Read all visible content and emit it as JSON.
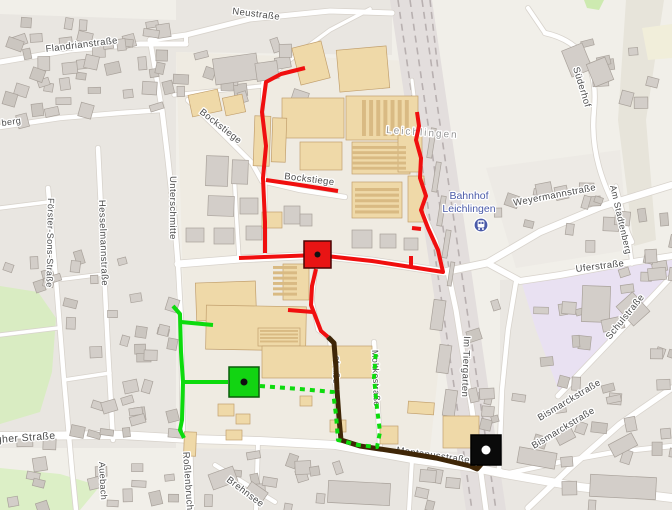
{
  "map": {
    "colors": {
      "base": "#f1efe9",
      "residential": "#e9e6e1",
      "industrial_land": "#efebe2",
      "park": "#d9ecc2",
      "school_area": "#e9e1f2",
      "railway_band": "#e3dedd",
      "railway_track": "#b8b0b0",
      "road_fill": "#ffffff",
      "road_casing": "#d8d3cc",
      "building_grey": "#d3cec9",
      "building_grey_stroke": "#a9a29b",
      "building_beige": "#efd9a8",
      "building_beige_stroke": "#c2a06e",
      "building_rows": "#d9ba83",
      "label_color": "#4c4c4c",
      "railway_label_color": "#969696",
      "station_color": "#4a5aa8",
      "route_red": "#f00f0f",
      "route_green": "#0ddb0d",
      "route_brown": "#3f2607"
    },
    "areas": [
      {
        "name": "residential-left",
        "d": "M0,14 L176,20 L176,448 L0,448 Z",
        "fill": "#e9e6e1",
        "opacity": 1
      },
      {
        "name": "residential-top",
        "d": "M176,0 L392,0 L392,55 L176,52 Z",
        "fill": "#e9e6e1",
        "opacity": 1
      },
      {
        "name": "residential-bottom",
        "d": "M188,448 L470,452 L470,510 L188,510 Z",
        "fill": "#e9e6e1",
        "opacity": 1
      },
      {
        "name": "residential-right",
        "d": "M500,280 L672,270 L672,510 L500,510 Z",
        "fill": "#eae7e2",
        "opacity": 1
      },
      {
        "name": "residential-rightmid",
        "d": "M486,168 L620,150 L628,250 L516,268 Z",
        "fill": "#ebe8e3",
        "opacity": 0.7
      },
      {
        "name": "industrial-center",
        "d": "M176,52 L440,62 L448,280 L430,450 L188,448 Z",
        "fill": "#efebe2",
        "opacity": 1
      },
      {
        "name": "park-left",
        "d": "M0,286 L38,292 L56,318 L52,372 L40,412 L0,424 Z",
        "fill": "#d9ecc2",
        "opacity": 1
      },
      {
        "name": "park-bottomleft",
        "d": "M0,468 L60,474 L100,486 L80,510 L0,510 Z",
        "fill": "#dcefc6",
        "opacity": 1
      },
      {
        "name": "green-topright",
        "d": "M584,0 L604,0 L599,10 L587,8 Z",
        "fill": "#cdeab0",
        "opacity": 1
      },
      {
        "name": "scrub-band-right",
        "d": "M626,0 L664,0 L646,120 L656,240 L634,246 L618,120 Z",
        "fill": "#dedacd",
        "opacity": 0.55
      },
      {
        "name": "farmland-right",
        "d": "M642,28 L672,24 L672,58 L648,60 Z",
        "fill": "#f1eeda",
        "opacity": 1
      },
      {
        "name": "school-area",
        "d": "M522,284 L672,258 L672,274 L560,394 L536,330 Z",
        "fill": "#e9e1f2",
        "opacity": 1
      }
    ],
    "railway": {
      "band": "M390,0 L432,0 L506,510 L466,510 Z",
      "tracks": [
        "M398,0 L472,510",
        "M410,0 L484,510",
        "M422,0 L496,510",
        "M430,0 L438,70"
      ]
    },
    "roads": [
      {
        "d": "M0,436 L120,435 L190,439 L260,441 L335,445 L412,459 L470,467 L505,474 L580,487 L672,498",
        "w": 8
      },
      {
        "d": "M178,264 L240,259 L317,255 L372,261 L412,267 L444,272 L487,263",
        "w": 7
      },
      {
        "d": "M487,263 L540,232 L600,207 L672,185",
        "w": 6.5
      },
      {
        "d": "M487,263 L520,281 L560,275 L620,264 L672,256",
        "w": 6
      },
      {
        "d": "M516,282 L508,330 L502,390 L499,470 L505,474",
        "w": 4.5
      },
      {
        "d": "M448,272 L456,310 L464,360 L472,410 L478,450 L480,466 L486,510",
        "w": 5
      },
      {
        "d": "M558,396 L600,352 L640,310 L672,276",
        "w": 5
      },
      {
        "d": "M528,508 L570,468 L620,424 L672,388",
        "w": 5.5
      },
      {
        "d": "M505,474 L560,462 L615,452 L672,446",
        "w": 4.5
      },
      {
        "d": "M545,33 C585,42 598,70 594,110 C590,150 602,185 622,220 L632,242",
        "w": 4.5
      },
      {
        "d": "M545,33 L528,8",
        "w": 4
      },
      {
        "d": "M616,186 L628,232 L632,264",
        "w": 3.5
      },
      {
        "d": "M0,62 L70,50 L140,44 L186,44",
        "w": 5
      },
      {
        "d": "M150,40 L186,35 L250,19 L330,11 L392,13",
        "w": 5
      },
      {
        "d": "M186,44 L186,35",
        "w": 4
      },
      {
        "d": "M0,127 L60,118 L120,113 L162,110",
        "w": 4.5
      },
      {
        "d": "M162,110 L168,160 L174,215 L178,264",
        "w": 5
      },
      {
        "d": "M150,40 L156,75 L162,110",
        "w": 4.5
      },
      {
        "d": "M174,95 L262,86",
        "w": 3.5
      },
      {
        "d": "M178,264 L181,320 L182,380 L183,440",
        "w": 4.5
      },
      {
        "d": "M190,440 L192,510",
        "w": 4.5
      },
      {
        "d": "M48,188 L56,280 L64,380 L72,470 L76,510",
        "w": 4.5
      },
      {
        "d": "M98,148 L103,250 L108,350 L113,440",
        "w": 4.5
      },
      {
        "d": "M0,208 L48,202",
        "w": 3.5
      },
      {
        "d": "M56,280 L104,274",
        "w": 3.5
      },
      {
        "d": "M64,380 L110,373",
        "w": 3.5
      },
      {
        "d": "M0,335 L58,328",
        "w": 3.5
      },
      {
        "d": "M370,9 L330,30 L296,55 L263,82 L262,140 L265,180 L265,252",
        "w": 3.5
      },
      {
        "d": "M188,100 L225,136 L252,163 L262,181",
        "w": 4.5
      },
      {
        "d": "M262,181 L300,190 L345,197",
        "w": 4.5
      },
      {
        "d": "M239,258 L236,210 L234,170",
        "w": 3.5
      },
      {
        "d": "M317,255 L312,300 L318,330 L330,339",
        "w": 3.5
      },
      {
        "d": "M330,339 L336,390 L340,443",
        "w": 4.5
      },
      {
        "d": "M374,342 L377,395 L380,445",
        "w": 4.5
      },
      {
        "d": "M258,442 L256,510",
        "w": 4
      },
      {
        "d": "M412,459 L409,510",
        "w": 4
      },
      {
        "d": "M215,465 L275,502",
        "w": 4
      },
      {
        "d": "M444,272 L436,240 L424,214 L422,184 L418,150 L416,112 L412,80",
        "w": 3
      }
    ],
    "buildings_beige": [
      [
        296,
        44,
        30,
        38,
        -14
      ],
      [
        338,
        48,
        50,
        42,
        -5
      ],
      [
        282,
        98,
        62,
        40,
        0
      ],
      [
        346,
        96,
        72,
        44,
        0
      ],
      [
        254,
        116,
        16,
        50,
        2
      ],
      [
        272,
        118,
        14,
        44,
        2
      ],
      [
        190,
        92,
        30,
        22,
        -12
      ],
      [
        224,
        96,
        20,
        18,
        -12
      ],
      [
        300,
        142,
        42,
        28,
        0
      ],
      [
        352,
        142,
        58,
        32,
        0
      ],
      [
        398,
        132,
        24,
        40,
        0
      ],
      [
        352,
        182,
        50,
        36,
        0
      ],
      [
        408,
        176,
        16,
        46,
        0
      ],
      [
        262,
        212,
        20,
        16,
        0
      ],
      [
        283,
        264,
        26,
        36,
        0
      ],
      [
        196,
        282,
        60,
        38,
        -2
      ],
      [
        206,
        306,
        100,
        44,
        1
      ],
      [
        258,
        328,
        42,
        18,
        0
      ],
      [
        262,
        346,
        110,
        32,
        0
      ],
      [
        300,
        396,
        12,
        10,
        0
      ],
      [
        218,
        404,
        16,
        12,
        0
      ],
      [
        236,
        414,
        14,
        10,
        0
      ],
      [
        226,
        430,
        16,
        10,
        0
      ],
      [
        184,
        432,
        12,
        24,
        2
      ],
      [
        443,
        416,
        36,
        32,
        0
      ],
      [
        408,
        402,
        26,
        12,
        4
      ],
      [
        380,
        426,
        18,
        18,
        0
      ],
      [
        330,
        420,
        16,
        12,
        0
      ]
    ],
    "building_rows": [
      [
        362,
        100,
        50,
        36,
        7,
        true
      ],
      [
        352,
        146,
        54,
        26,
        5,
        false
      ],
      [
        355,
        188,
        44,
        28,
        5,
        false
      ],
      [
        273,
        266,
        24,
        32,
        6,
        false
      ],
      [
        260,
        330,
        38,
        14,
        4,
        false
      ]
    ],
    "buildings_grey": [
      [
        214,
        56,
        44,
        26,
        -8
      ],
      [
        256,
        62,
        22,
        18,
        -8
      ],
      [
        566,
        46,
        22,
        28,
        -22
      ],
      [
        590,
        60,
        20,
        24,
        -22
      ],
      [
        582,
        286,
        28,
        36,
        2
      ],
      [
        622,
        296,
        22,
        26,
        -42
      ],
      [
        648,
        268,
        18,
        12,
        -5
      ],
      [
        562,
        302,
        14,
        12,
        4
      ],
      [
        602,
        318,
        22,
        12,
        -12
      ],
      [
        590,
        476,
        66,
        22,
        3
      ],
      [
        518,
        450,
        38,
        16,
        10
      ],
      [
        610,
        438,
        26,
        14,
        -28
      ],
      [
        556,
        430,
        18,
        12,
        -28
      ],
      [
        206,
        156,
        22,
        30,
        2
      ],
      [
        232,
        160,
        16,
        24,
        2
      ],
      [
        208,
        196,
        26,
        20,
        2
      ],
      [
        240,
        198,
        18,
        16,
        0
      ],
      [
        186,
        228,
        18,
        14,
        0
      ],
      [
        214,
        228,
        20,
        16,
        0
      ],
      [
        246,
        226,
        16,
        14,
        0
      ],
      [
        284,
        206,
        16,
        18,
        0
      ],
      [
        300,
        214,
        12,
        12,
        0
      ],
      [
        352,
        230,
        20,
        18,
        0
      ],
      [
        380,
        234,
        16,
        14,
        0
      ],
      [
        404,
        238,
        14,
        12,
        0
      ],
      [
        429,
        128,
        5,
        30,
        9
      ],
      [
        434,
        162,
        5,
        30,
        9
      ],
      [
        439,
        196,
        5,
        30,
        9
      ],
      [
        444,
        230,
        5,
        28,
        9
      ],
      [
        449,
        262,
        4,
        24,
        9
      ],
      [
        328,
        482,
        62,
        22,
        3
      ],
      [
        210,
        470,
        26,
        16,
        -20
      ],
      [
        246,
        486,
        20,
        14,
        35
      ],
      [
        432,
        300,
        12,
        30,
        8
      ],
      [
        438,
        345,
        12,
        28,
        8
      ],
      [
        444,
        390,
        12,
        26,
        8
      ],
      [
        420,
        470,
        16,
        12,
        5
      ],
      [
        446,
        478,
        14,
        10,
        5
      ]
    ],
    "house_regions": [
      [
        2,
        16,
        172,
        104,
        44
      ],
      [
        60,
        250,
        112,
        182,
        30
      ],
      [
        2,
        252,
        56,
        34,
        6
      ],
      [
        2,
        428,
        170,
        80,
        18
      ],
      [
        176,
        28,
        118,
        64,
        14
      ],
      [
        452,
        300,
        44,
        150,
        8
      ],
      [
        505,
        300,
        165,
        205,
        30
      ],
      [
        492,
        182,
        110,
        66,
        12
      ],
      [
        195,
        450,
        250,
        56,
        18
      ],
      [
        556,
        36,
        100,
        70,
        8
      ],
      [
        600,
        190,
        72,
        95,
        12
      ]
    ],
    "labels": [
      {
        "text": "Neustraße",
        "x": 232,
        "y": 14,
        "rot": 7,
        "size": 9.5
      },
      {
        "text": "Flandrianstraße",
        "x": 46,
        "y": 52,
        "rot": -7,
        "size": 9.5
      },
      {
        "text": "berg",
        "x": 2,
        "y": 126,
        "rot": -8,
        "size": 9
      },
      {
        "text": "Bockstiege",
        "x": 199,
        "y": 113,
        "rot": 38,
        "size": 9.5
      },
      {
        "text": "Bockstiege",
        "x": 284,
        "y": 179,
        "rot": 7,
        "size": 9.5
      },
      {
        "text": "Unterschmitte",
        "x": 170,
        "y": 176,
        "rot": 90,
        "size": 9.5
      },
      {
        "text": "Hesselmannstraße",
        "x": 99,
        "y": 200,
        "rot": 88,
        "size": 9.5
      },
      {
        "text": "Förster-Sons-Straße",
        "x": 48,
        "y": 198,
        "rot": 91,
        "size": 9
      },
      {
        "text": "gher Straße",
        "x": -4,
        "y": 443,
        "rot": -4,
        "size": 10.5
      },
      {
        "text": "Roßlenbruch",
        "x": 183,
        "y": 452,
        "rot": 86,
        "size": 9.5
      },
      {
        "text": "Brehnsee",
        "x": 226,
        "y": 481,
        "rot": 37,
        "size": 9.5
      },
      {
        "text": "Auebach",
        "x": 99,
        "y": 462,
        "rot": 87,
        "size": 9
      },
      {
        "text": "Leichlingen",
        "x": 386,
        "y": 133,
        "rot": 4,
        "size": 10,
        "color": "#969696",
        "spacing": 2
      },
      {
        "text": "Weyermannstraße",
        "x": 514,
        "y": 206,
        "rot": -11,
        "size": 9.5
      },
      {
        "text": "Süderhof",
        "x": 573,
        "y": 68,
        "rot": 73,
        "size": 9.5
      },
      {
        "text": "Uferstraße",
        "x": 576,
        "y": 272,
        "rot": -7,
        "size": 9.5
      },
      {
        "text": "Schulstraße",
        "x": 610,
        "y": 340,
        "rot": -51,
        "size": 9.5
      },
      {
        "text": "Im Tiergarten",
        "x": 464,
        "y": 336,
        "rot": 92,
        "size": 9.5
      },
      {
        "text": "Moltkestraße",
        "x": 372,
        "y": 350,
        "rot": 88,
        "size": 9
      },
      {
        "text": "straße",
        "x": 334,
        "y": 356,
        "rot": 92,
        "size": 9
      },
      {
        "text": "Montanusstraße",
        "x": 396,
        "y": 453,
        "rot": 8,
        "size": 9.5
      },
      {
        "text": "Bismarckstraße",
        "x": 540,
        "y": 421,
        "rot": -31,
        "size": 9.5
      },
      {
        "text": "Bismarckstraße",
        "x": 534,
        "y": 449,
        "rot": -31,
        "size": 9.5
      },
      {
        "text": "Am Stadtenberg",
        "x": 610,
        "y": 186,
        "rot": 77,
        "size": 9
      }
    ],
    "station": {
      "line1": "Bahnhof",
      "line2": "Leichlingen",
      "text_x": 469,
      "text_y": 199,
      "icon_x": 481,
      "icon_y": 225,
      "color": "#4a5aa8"
    },
    "routes": {
      "red": {
        "color": "#f00f0f",
        "width": 4,
        "paths": [
          "M305,68 L281,74 L266,82 L262,112 L266,146 L263,178 L265,222 L265,253",
          "M266,180 L300,185 L338,191",
          "M239,258 L317,255 L372,261 L411,267 L443,272 L438,250 L428,228 L421,210 L426,196 L420,178 L421,158 L416,140 L419,126 L417,112",
          "M411,267 L411,256",
          "M421,229 L412,228",
          "M316,269 L312,286 L311,305 L316,318 L321,331 L328,337",
          "M313,312 L288,310"
        ]
      },
      "green": {
        "color": "#0ddb0d",
        "width": 4,
        "paths": [
          "M173,306 L180,314 L181,352 L183,382 L182,420 L180,430 L184,438",
          "M181,322 L213,325",
          "M184,382 L228,382"
        ]
      },
      "brown": {
        "color": "#3f2607",
        "width": 5,
        "paths": [
          "M328,337 L334,343 L336,368 L337,390 L339,418 L341,440 L360,446 L400,452 L436,458 L470,466 L477,469 L484,461 L486,453"
        ]
      },
      "green_dashed": {
        "color": "#0ddb0d",
        "width": 4,
        "dash": "5 5",
        "paths": [
          "M260,386 L300,389 L333,392 L336,415 L338,440 L358,445 L377,447 L380,432 L377,408 L374,378 L376,350"
        ]
      }
    },
    "markers": [
      {
        "id": "red-square",
        "x": 304,
        "y": 241,
        "size": 27,
        "fill": "#e81414",
        "stroke": "#4a0505",
        "dot": "#111111",
        "dot_r": 3
      },
      {
        "id": "green-square",
        "x": 229,
        "y": 367,
        "size": 30,
        "fill": "#12d412",
        "stroke": "#0a5c0a",
        "dot": "#111111",
        "dot_r": 3.5
      },
      {
        "id": "black-square",
        "x": 471,
        "y": 435,
        "size": 30,
        "fill": "#0a0a0a",
        "stroke": "#000000",
        "dot": "#ffffff",
        "dot_r": 4.5
      }
    ]
  }
}
